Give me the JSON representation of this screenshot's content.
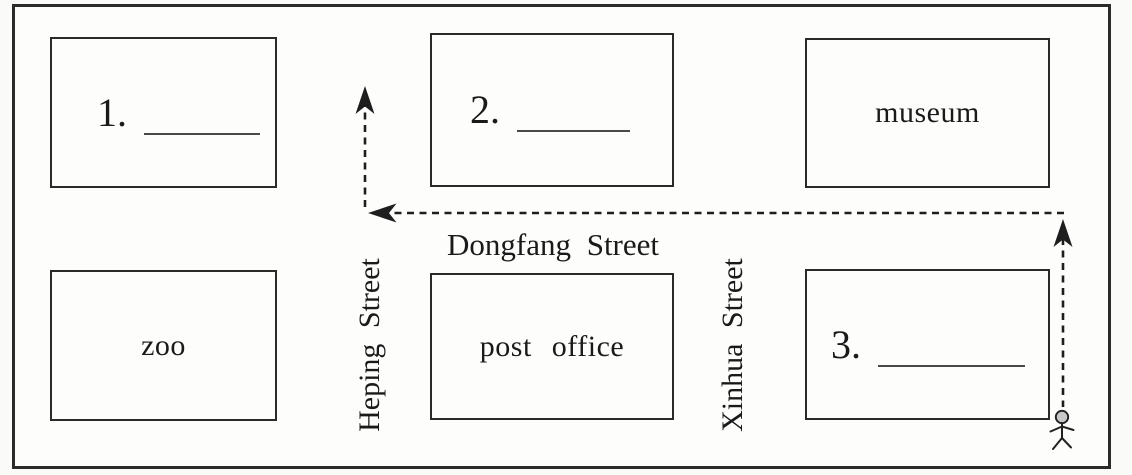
{
  "worksheet": {
    "kind": "street map fill-in-the-blank exercise",
    "streets": {
      "horizontal": "Dongfang Street",
      "left_vertical": "Heping Street",
      "right_vertical": "Xinhua Street"
    },
    "blocks": {
      "blank1": {
        "number": "1."
      },
      "blank2": {
        "number": "2."
      },
      "museum": {
        "label": "museum"
      },
      "zoo": {
        "label": "zoo"
      },
      "post_office": {
        "label": "post office"
      },
      "blank3": {
        "number": "3."
      }
    },
    "route": {
      "marker": "person-icon",
      "description": "dashed route from person marker going north along Xinhua Street, west along Dongfang Street, then north up Heping Street"
    },
    "colors": {
      "line": "#1e1e1e",
      "paper": "#fdfdfc",
      "person_head_fill": "#c8c8c8"
    }
  }
}
